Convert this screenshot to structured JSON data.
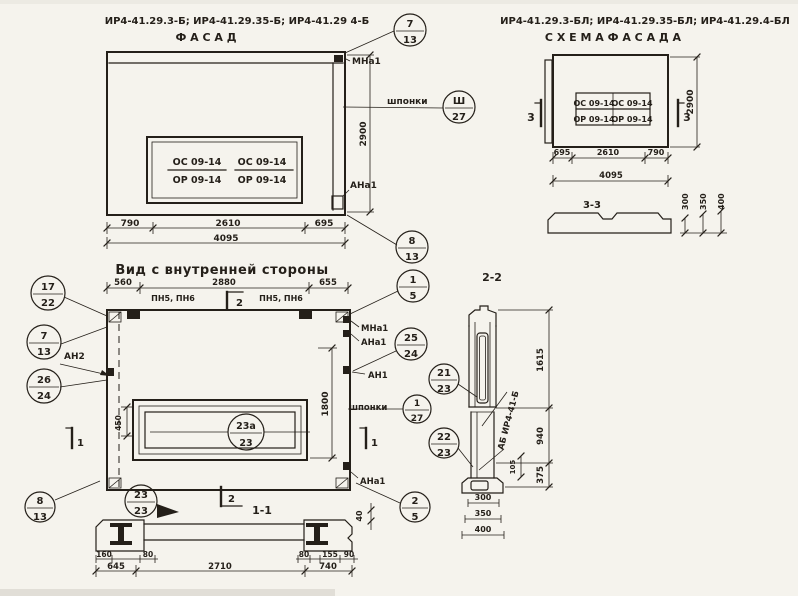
{
  "palette": {
    "paper": "#f5f3ed",
    "ink": "#241f19"
  },
  "facade": {
    "title": "ИР4-41.29.3-Б; ИР4-41.29.35-Б; ИР4-41.29 4-Б",
    "subtitle": "Ф А С А Д",
    "window": {
      "c1_top": "ОС 09-14",
      "c1_bot": "ОР 09-14",
      "c2_top": "ОС 09-14",
      "c2_bot": "ОР 09-14"
    },
    "labels": {
      "mna1": "МНа1",
      "shponki": "шпонки",
      "ana1": "АНа1"
    },
    "dims": {
      "left": "790",
      "mid": "2610",
      "right": "695",
      "total": "4095",
      "height": "2900"
    },
    "callouts": {
      "top": {
        "num": "7",
        "den": "13"
      },
      "shponki": {
        "num": "Ш",
        "den": "27"
      },
      "bottom": {
        "num": "8",
        "den": "13"
      }
    }
  },
  "scheme": {
    "title": "ИР4-41.29.3-БЛ; ИР4-41.29.35-БЛ; ИР4-41.29.4-БЛ",
    "subtitle": "С Х Е М А   Ф А С А Д А",
    "window": {
      "c1_top": "ОС 09-14",
      "c1_bot": "ОР 09-14",
      "c2_top": "ОС 09-14",
      "c2_bot": "ОР 09-14"
    },
    "markers": {
      "left": "3",
      "right": "3"
    },
    "dims": {
      "left": "695",
      "mid": "2610",
      "right": "790",
      "total": "4095",
      "height": "2900"
    }
  },
  "section33": {
    "title": "3-3",
    "dims": {
      "d1": "300",
      "d2": "350",
      "d3": "400"
    }
  },
  "inner": {
    "title": "Вид с внутренней стороны",
    "dims_top": {
      "left": "560",
      "mid": "2880",
      "right": "655"
    },
    "labels": {
      "pn_left": "ПН5, ПН6",
      "pn_right": "ПН5, ПН6",
      "an2": "АН2",
      "mna1": "МНа1",
      "ana1_top": "АНа1",
      "an1": "АН1",
      "shponki": "шпонки",
      "ana1_bot": "АНа1"
    },
    "markers": {
      "m2_top": "2",
      "m1_left": "1",
      "m1_right": "1"
    },
    "dims": {
      "h1800": "1800",
      "v450": "450",
      "v40": "40"
    },
    "callouts": {
      "c17_22": {
        "num": "17",
        "den": "22"
      },
      "c7_13": {
        "num": "7",
        "den": "13"
      },
      "c26_24": {
        "num": "26",
        "den": "24"
      },
      "c1_5": {
        "num": "1",
        "den": "5"
      },
      "c25_24": {
        "num": "25",
        "den": "24"
      },
      "c1_27": {
        "num": "1",
        "den": "27"
      },
      "c23a_23": {
        "num": "23а",
        "den": "23"
      },
      "c2_5": {
        "num": "2",
        "den": "5"
      },
      "c8_13": {
        "num": "8",
        "den": "13"
      }
    }
  },
  "section11": {
    "title": "1-1",
    "marker2": "2",
    "callout": {
      "num": "23",
      "den": "23"
    },
    "dims": {
      "d160": "160",
      "d80l": "80",
      "d645": "645",
      "d2710": "2710",
      "d80r": "80",
      "d155": "155",
      "d90": "90",
      "d740": "740"
    }
  },
  "section22": {
    "title": "2-2",
    "diag_label": "АБ ИР4-41-Б",
    "dims": {
      "d1615": "1615",
      "d940": "940",
      "d375": "375",
      "d105": "105",
      "w300": "300",
      "w350": "350",
      "w400": "400"
    },
    "callouts": {
      "c21_23": {
        "num": "21",
        "den": "23"
      },
      "c22_23": {
        "num": "22",
        "den": "23"
      }
    }
  }
}
